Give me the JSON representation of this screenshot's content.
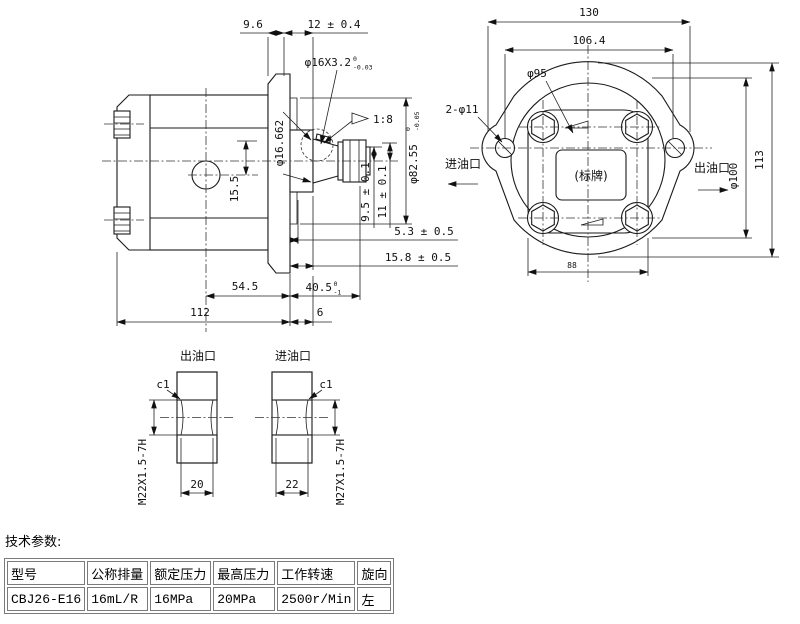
{
  "side_view": {
    "top_dims": {
      "plate": "9.6",
      "shaft_end": "12 ± 0.4"
    },
    "key_dim": {
      "main": "φ16X3.2",
      "tol_upper": "0",
      "tol_lower": "-0.03"
    },
    "taper_ratio": "1:8",
    "taper_gauge_dia": "φ16.662",
    "key_height_1": "9.5 ± 0.1",
    "key_height_2": "11 ± 0.1",
    "spigot_dia": {
      "main": "φ82.55",
      "tol_upper": "0",
      "tol_lower": "-0.05"
    },
    "dim_5_3": "5.3 ± 0.5",
    "dim_15_8": "15.8 ± 0.5",
    "dim_54_5": "54.5",
    "shaft_len": {
      "main": "40.5",
      "tol_upper": "0",
      "tol_lower": "-1"
    },
    "body_len": "112",
    "dim_6": "6",
    "port_offset": "15.5"
  },
  "flange_view": {
    "width": "130",
    "bolt_spacing": "106.4",
    "pilot_dia": "φ95",
    "mount_holes": "2-φ11",
    "inlet_label": "进油口",
    "outlet_label": "出油口",
    "nameplate": "(标牌)",
    "dia_100": "φ100",
    "height": "113",
    "body_width": "88"
  },
  "port_sections": {
    "outlet": {
      "title": "出油口",
      "chamfer": "c1",
      "thread": "M22X1.5-7H",
      "bore_width": "20"
    },
    "inlet": {
      "title": "进油口",
      "chamfer": "c1",
      "thread": "M27X1.5-7H",
      "bore_width": "22"
    }
  },
  "tech_params": {
    "title": "技术参数:",
    "headers": [
      "型号",
      "公称排量",
      "额定压力",
      "最高压力",
      "工作转速",
      "旋向"
    ],
    "values": [
      "CBJ26-E16",
      "16mL/R",
      "16MPa",
      "20MPa",
      "2500r/Min",
      "左"
    ]
  }
}
